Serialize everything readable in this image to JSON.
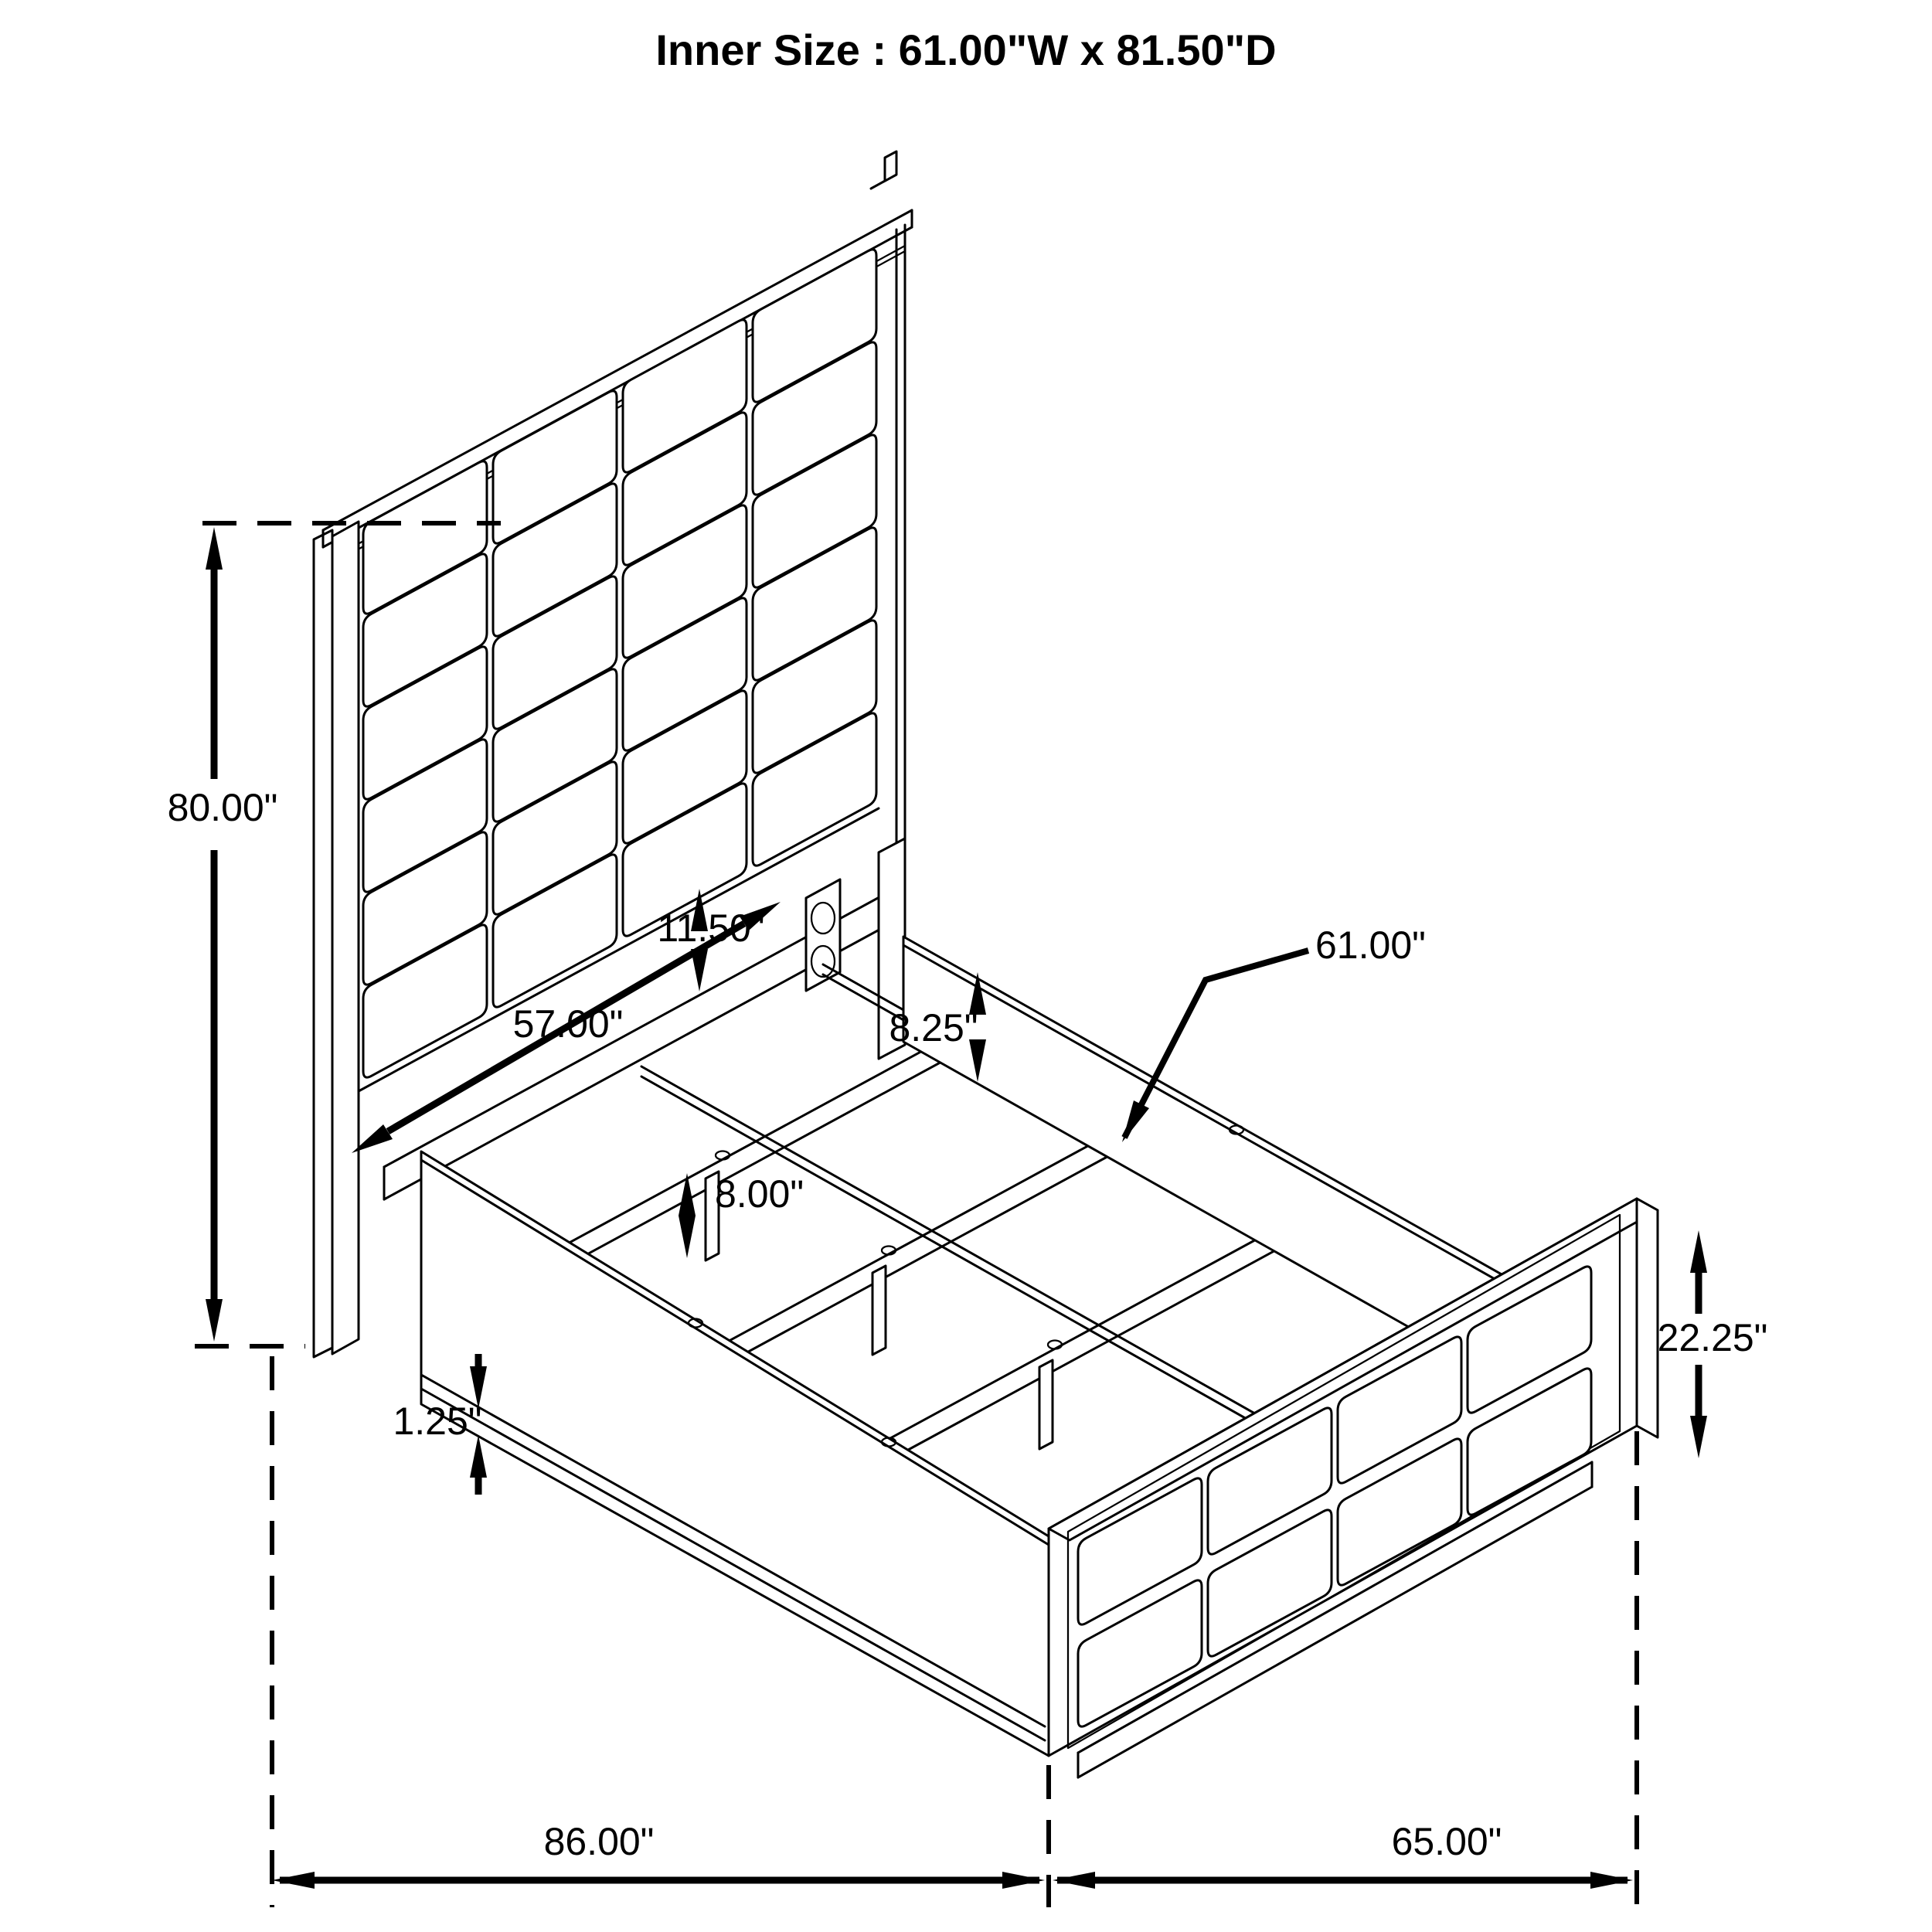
{
  "title": "Inner Size : 61.00\"W x 81.50\"D",
  "inner_size": {
    "width_in": 61.0,
    "depth_in": 81.5
  },
  "dimensions": {
    "headboard_height": "80.00\"",
    "headboard_gap": "11.50\"",
    "inner_rail_width": "57.00\"",
    "rail_top_height": "8.25\"",
    "slat_length": "61.00\"",
    "support_leg_height": "8.00\"",
    "rail_thickness": "1.25\"",
    "footboard_height": "22.25\"",
    "overall_length": "86.00\"",
    "overall_width": "65.00\""
  },
  "colors": {
    "line": "#000000",
    "background": "#ffffff"
  }
}
